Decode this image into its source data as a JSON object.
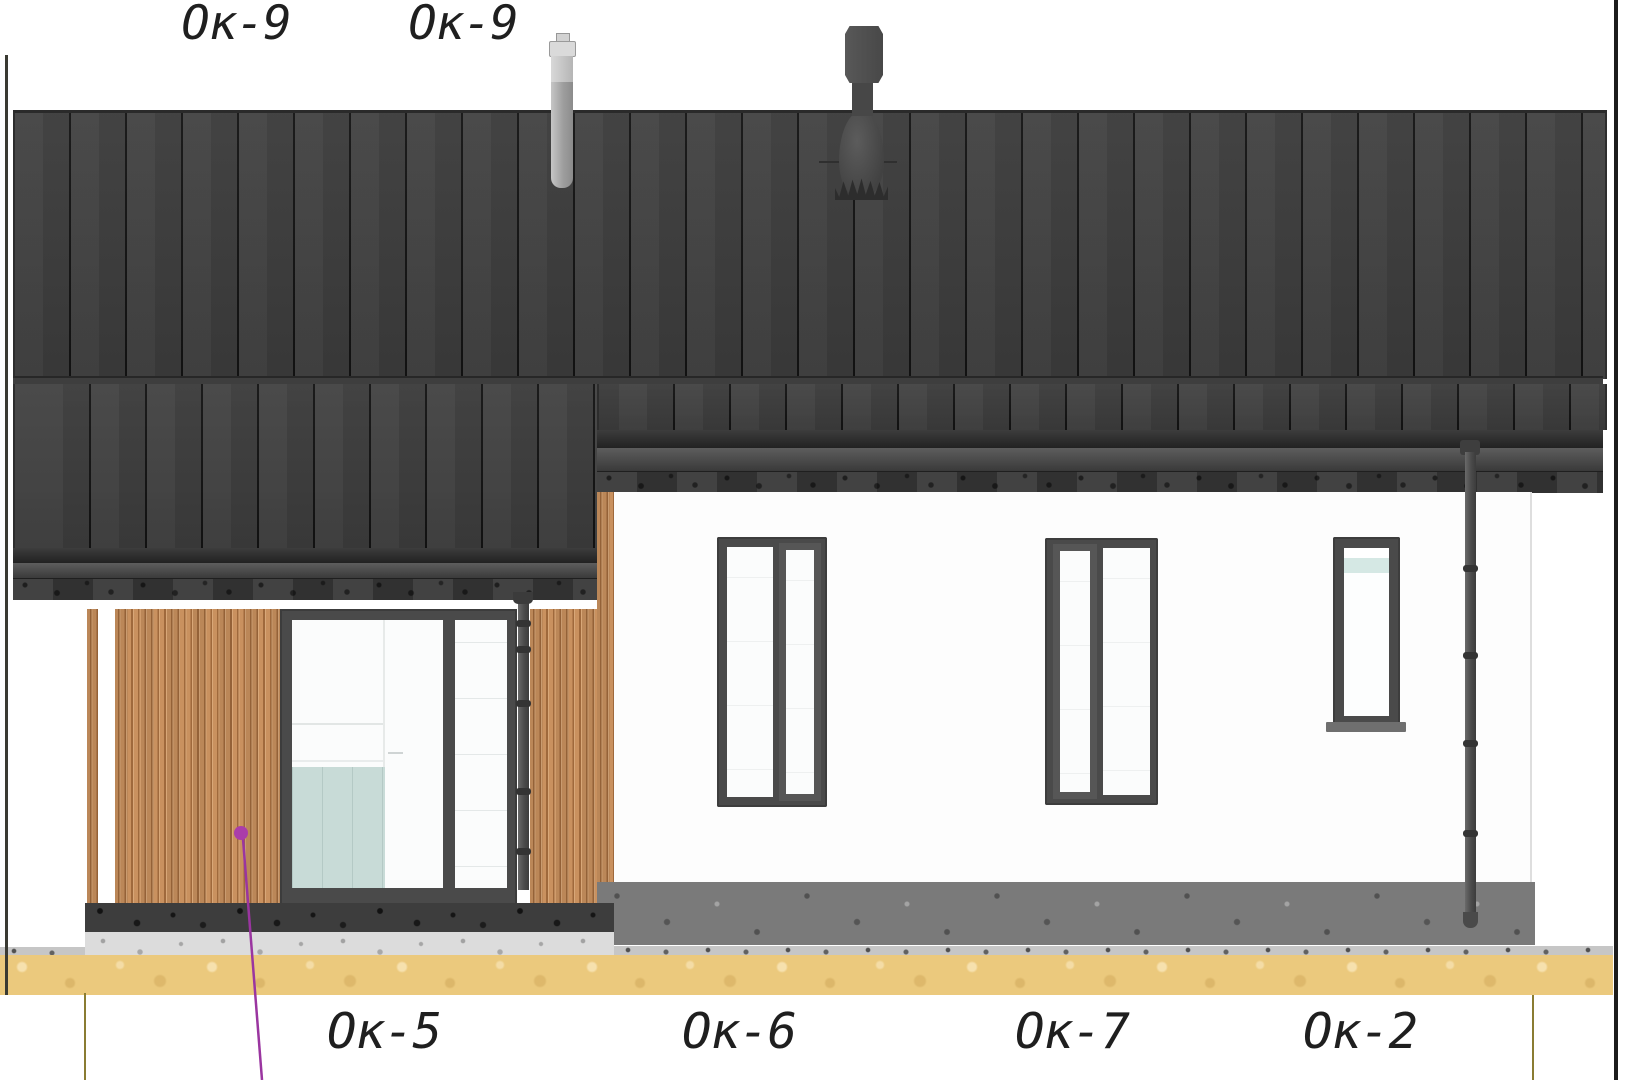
{
  "drawing": {
    "kind": "house-side-elevation",
    "labels": {
      "top": [
        {
          "text": "Ок-9"
        },
        {
          "text": "Ок-9"
        }
      ],
      "bottom": [
        {
          "text": "Ок-5"
        },
        {
          "text": "Ок-6"
        },
        {
          "text": "Ок-7"
        },
        {
          "text": "Ок-2"
        }
      ]
    },
    "colors": {
      "roof": "#3e3e3e",
      "wood_cladding": "#c9915f",
      "wall": "#fdfdfd",
      "window_frame": "#4a4a4a",
      "plinth": "#7a7a7a",
      "ground_sand": "#ebc97d",
      "leader_accent": "#aa3daa"
    },
    "elements": [
      "standing-seam-roof",
      "roof-vent-pipe",
      "roof-chimney-vent",
      "gutter-and-fascia",
      "porch-wood-cladding",
      "sliding-glass-door",
      "porch-downpipe",
      "window-ok6",
      "window-ok7",
      "window-ok2",
      "wall-downpipe",
      "plinth",
      "ground-line"
    ]
  }
}
